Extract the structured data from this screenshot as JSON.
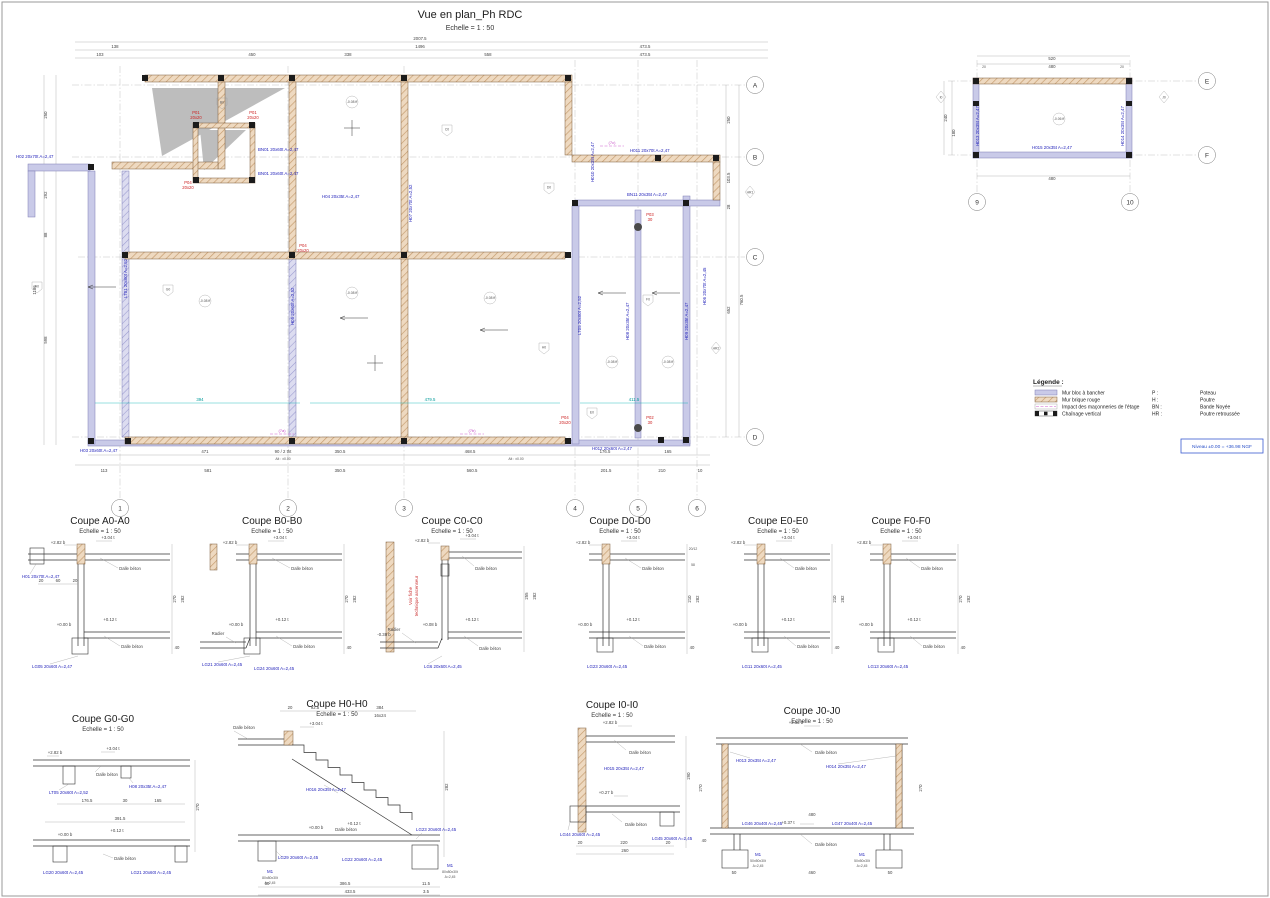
{
  "titles": {
    "plan": "Vue en plan_Ph RDC"
  },
  "common": {
    "scale": "Echelle = 1 : 50",
    "dalle": "Dalle béton",
    "radier": "Radier"
  },
  "legend": {
    "title": "Légende :",
    "wall_items": [
      "Mur bloc à bancher",
      "Mur brique rouge",
      "Impact des maçonneries de l'étage",
      "Chaînage vertical"
    ],
    "abbr": [
      [
        "P :",
        "Poteau"
      ],
      [
        "H :",
        "Poutre"
      ],
      [
        "BN :",
        "Bande Noyée"
      ],
      [
        "HR :",
        "Poutre retroussée"
      ]
    ],
    "niveau": "Niveau ±0.00 = +36.98 NGF"
  },
  "grid": {
    "cols": [
      "1",
      "2",
      "3",
      "4",
      "5",
      "6"
    ],
    "rows": [
      "A",
      "B",
      "C",
      "D"
    ],
    "small_cols": [
      "9",
      "10"
    ],
    "small_rows": [
      "E",
      "F"
    ]
  },
  "markers": {
    "coupe_ids": [
      "A0",
      "B0",
      "C0",
      "D0",
      "E0",
      "F0",
      "G0",
      "H0",
      "I0",
      "J0"
    ],
    "hr": [
      "HR1",
      "HR2"
    ]
  },
  "plan": {
    "dims_top": [
      "2007.5",
      "138",
      "1496",
      "473.5",
      "103",
      "450",
      "338",
      "558"
    ],
    "dims_bottom": [
      "471",
      "90 / 2 tht",
      "350.5",
      "468.5",
      "176.5",
      "165",
      "113",
      "581",
      "560.5",
      "201.5",
      "210",
      "10",
      "Alt : ±0.00"
    ],
    "dims_left": [
      "250",
      "292",
      "88",
      "598",
      "1186"
    ],
    "dims_right": [
      "250",
      "103.5",
      "28",
      "652",
      "760.5"
    ],
    "dims_cyan": [
      "394",
      "479.5",
      "411.5"
    ],
    "labels": {
      "H02": "H02 20x70t  A=2,47",
      "H03": "H03 20x60t  A=2,47",
      "H04": "H04 20x35t  A=2,47",
      "H05": "H05 20x60t  A=2,52",
      "H06": "H06 20x70t  A=2,45",
      "H07": "H07 20x70t  A=2,52",
      "H08": "H08 20x35t  A=2,47",
      "H09": "H09 20x35t  A=2,47",
      "H010": "H010 20x35t  A=2,47",
      "H011": "H011 20x70t  A=2,47",
      "H012": "H012 20x60t  A=2,47",
      "BN01": "BN01 20x60t  A=2,47",
      "BN11": "BN11 20x35t  A=2,47",
      "LT01": "LT01 20x60t  A=2,52",
      "LT05": "LT05 20x60t  A=2,52",
      "P01": "P01",
      "P02": "P02",
      "P03": "P03",
      "P04": "P04",
      "sz2020": "20x20",
      "sz30": "30",
      "level": "-0.08 ff",
      "m7a": "(7a)",
      "m7b": "(7b)",
      "m7c": "(7c)"
    }
  },
  "small_plan": {
    "dims": [
      "520",
      "480",
      "240",
      "180",
      "20"
    ],
    "labels": {
      "H013": "H013 20x35t  A=2,47",
      "H014": "H014 20x35t  A=2,47",
      "H015": "H015 20x35t  A=2,47",
      "level": "-0.06 ff"
    }
  },
  "coupes": [
    {
      "title": "Coupe A0-A0",
      "l1": "H01 20x70t  A=2,47",
      "l2": "LG05 20x60t  A=2,47",
      "e1": "+2.82 b",
      "e2": "+3.04 t",
      "e3": "+0.00 b",
      "e4": "+0.12 t",
      "dA": "20",
      "dB": "60",
      "dC": "20",
      "dD": "270",
      "dE": "282",
      "dF": "40"
    },
    {
      "title": "Coupe B0-B0",
      "l1": "LG21 20x60t  A=2,45",
      "l2": "LG24 20x60t  A=2,45",
      "e1": "+2.82 b",
      "e2": "+3.04 t",
      "e3": "+0.00 b",
      "e4": "+0.12 t",
      "dD": "270",
      "dE": "282",
      "dF": "40"
    },
    {
      "title": "Coupe C0-C0",
      "noteA": "Voir fiche",
      "noteB": "technique ascenseur",
      "l1": "LG6 20x60t  A=2,45",
      "e1": "+2.82 b",
      "e2": "+3.04 t",
      "e3": "+0.08 b",
      "e4": "+0.12 t",
      "e5": "-0.38 b",
      "dD": "255",
      "dE": "282"
    },
    {
      "title": "Coupe D0-D0",
      "l1": "LG23 20x60t  A=2,45",
      "e1": "+2.82 b",
      "e2": "+3.04 t",
      "e3": "+0.00 b",
      "e4": "+0.12 t",
      "dA": "20/12",
      "dB": "58",
      "dD": "210",
      "dE": "282",
      "dF": "40"
    },
    {
      "title": "Coupe E0-E0",
      "l1": "LG11 20x60t  A=2,45",
      "e1": "+2.82 b",
      "e2": "+3.04 t",
      "e3": "+0.00 b",
      "e4": "+0.12 t",
      "dD": "210",
      "dE": "282",
      "dF": "40"
    },
    {
      "title": "Coupe F0-F0",
      "l1": "LG13 20x60t  A=2,45",
      "e1": "+2.82 b",
      "e2": "+3.04 t",
      "e3": "+0.00 b",
      "e4": "+0.12 t",
      "dD": "270",
      "dE": "282",
      "dF": "40"
    },
    {
      "title": "Coupe G0-G0",
      "l1": "LT05 20x60t  A=2,52",
      "l2": "H08 20x35t  A=2,47",
      "l3": "LG20 20x60t  A=2,45",
      "l4": "LG21 20x60t  A=2,45",
      "e1": "+2.82 b",
      "e2": "+3.04 t",
      "e3": "+0.00 b",
      "e4": "+0.12 t",
      "dA": "176.5",
      "dB": "30",
      "dC": "165",
      "dD": "391.5",
      "dE": "270"
    },
    {
      "title": "Coupe H0-H0",
      "l1": "H016 20x35t  A=2,47",
      "l2": "LG29 20x60t  A=2,45",
      "l3": "LG22 20x60t  A=2,45",
      "l4": "LG23 20x60t  A=2,45",
      "m1": "M1",
      "m1sz": "80x80x30t",
      "m1a": "A=2,45",
      "e2": "+3.04 t",
      "e3": "+0.00 b",
      "e4": "+0.12 t",
      "dA": "92.5",
      "dB": "384",
      "dC": "16x24",
      "dD": "386.5",
      "dE": "433.5",
      "dF": "50",
      "dG": "11.5",
      "dH": "3.5",
      "dI": "282",
      "dJ": "20"
    },
    {
      "title": "Coupe I0-I0",
      "l1": "H015 20x35t  A=2,47",
      "l3": "LG44 20x60t  A=2,45",
      "l4": "LG45 20x60t  A=2,45",
      "e1": "+2.82 b",
      "e5": "+0.27 b",
      "dA": "20",
      "dB": "220",
      "dD": "260",
      "dE": "290"
    },
    {
      "title": "Coupe J0-J0",
      "l1": "H013 20x35t  A=2,47",
      "l2": "H014 20x35t  A=2,47",
      "l3": "LG46 20x40t  A=2,45",
      "l4": "LG47 20x40t  A=2,45",
      "m1": "M1",
      "m1sz": "50x50x30t",
      "m1a": "A=2,45",
      "e1": "+2.82 b",
      "e5": "+0.37 t",
      "dA": "50",
      "dB": "460",
      "dC": "50",
      "dD": "480",
      "dE": "270",
      "dF": "40"
    }
  ]
}
